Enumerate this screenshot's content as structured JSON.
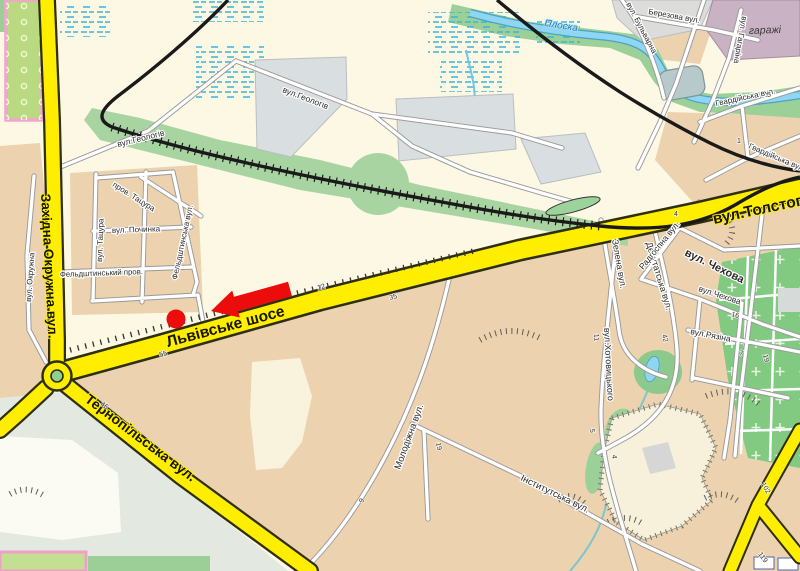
{
  "map": {
    "marker": {
      "type": "red-arrow-with-dot"
    },
    "streets": {
      "zakhidna_okruzhna": "Західна Окружна вул.",
      "lvivske_shose": "Львівське шосе",
      "tolstoho": "вул.Толстого",
      "ternopilska": "Тернопільська вул.",
      "heolohiv_w": "вул.Геологів",
      "heolohiv_e": "вул.Геологів",
      "okruzhna_small": "вул. Окружна",
      "prov_tatsura": "пров. Тацура",
      "vul_tatsura": "вул. Тацура",
      "pochynka": "вул. Починка",
      "feldshtynska": "Фельдштинська вул.",
      "feldshtynskyi_prov": "Фельдштинський пров.",
      "molodizhna": "Молодіжна вул.",
      "instytutska": "Інститутська вул.",
      "khotovytskoho": "вул.Хотовицького",
      "zelena": "Зелена вул.",
      "deputatska": "Депутатська вул.",
      "radhospna": "Радгоспна вул.",
      "chekhova_major": "вул. Чехова",
      "chekhova_minor": "вул.Чехова",
      "riazina": "вул.Рязіна",
      "hvardiiska_n": "Гвардійська вул.",
      "hvardiiska_s": "Гвардійська вул.",
      "haharina": "вул. Гагаріна",
      "bulvarna": "вул. Бульварна",
      "berezova": "Березова вул."
    },
    "water": {
      "ploska": "Плоска"
    },
    "places": {
      "harazhi": "гаражі"
    },
    "house_numbers": {
      "lvivske_12": "12",
      "lvivske_35": "35",
      "lvivske_55": "55",
      "ternopilska_46": "46",
      "molodizhna_9": "9",
      "molodizhna_19": "19",
      "khotovytskoho_11": "11",
      "khotovytskoho_5": "5",
      "khotovytskoho_4": "4",
      "deputatska_42": "42",
      "chekhova_16": "16",
      "riazina_7": "7",
      "riazina_19": "19",
      "radhospna_4": "4",
      "hvardiiska_1": "1",
      "hvardiiska_5": "5",
      "road_102": "102",
      "road_119": "119"
    },
    "colors": {
      "major_road_yellow": "#ffee00",
      "land_tan": "#ecd2ae",
      "background_cream": "#fdf8e3",
      "vegetation_green": "#a8d4a2",
      "water_blue": "#6ec7e8",
      "marker_red": "#ed0c0c",
      "railway_black": "#1a1a1a",
      "garages_mauve": "#c9b2c4"
    }
  }
}
